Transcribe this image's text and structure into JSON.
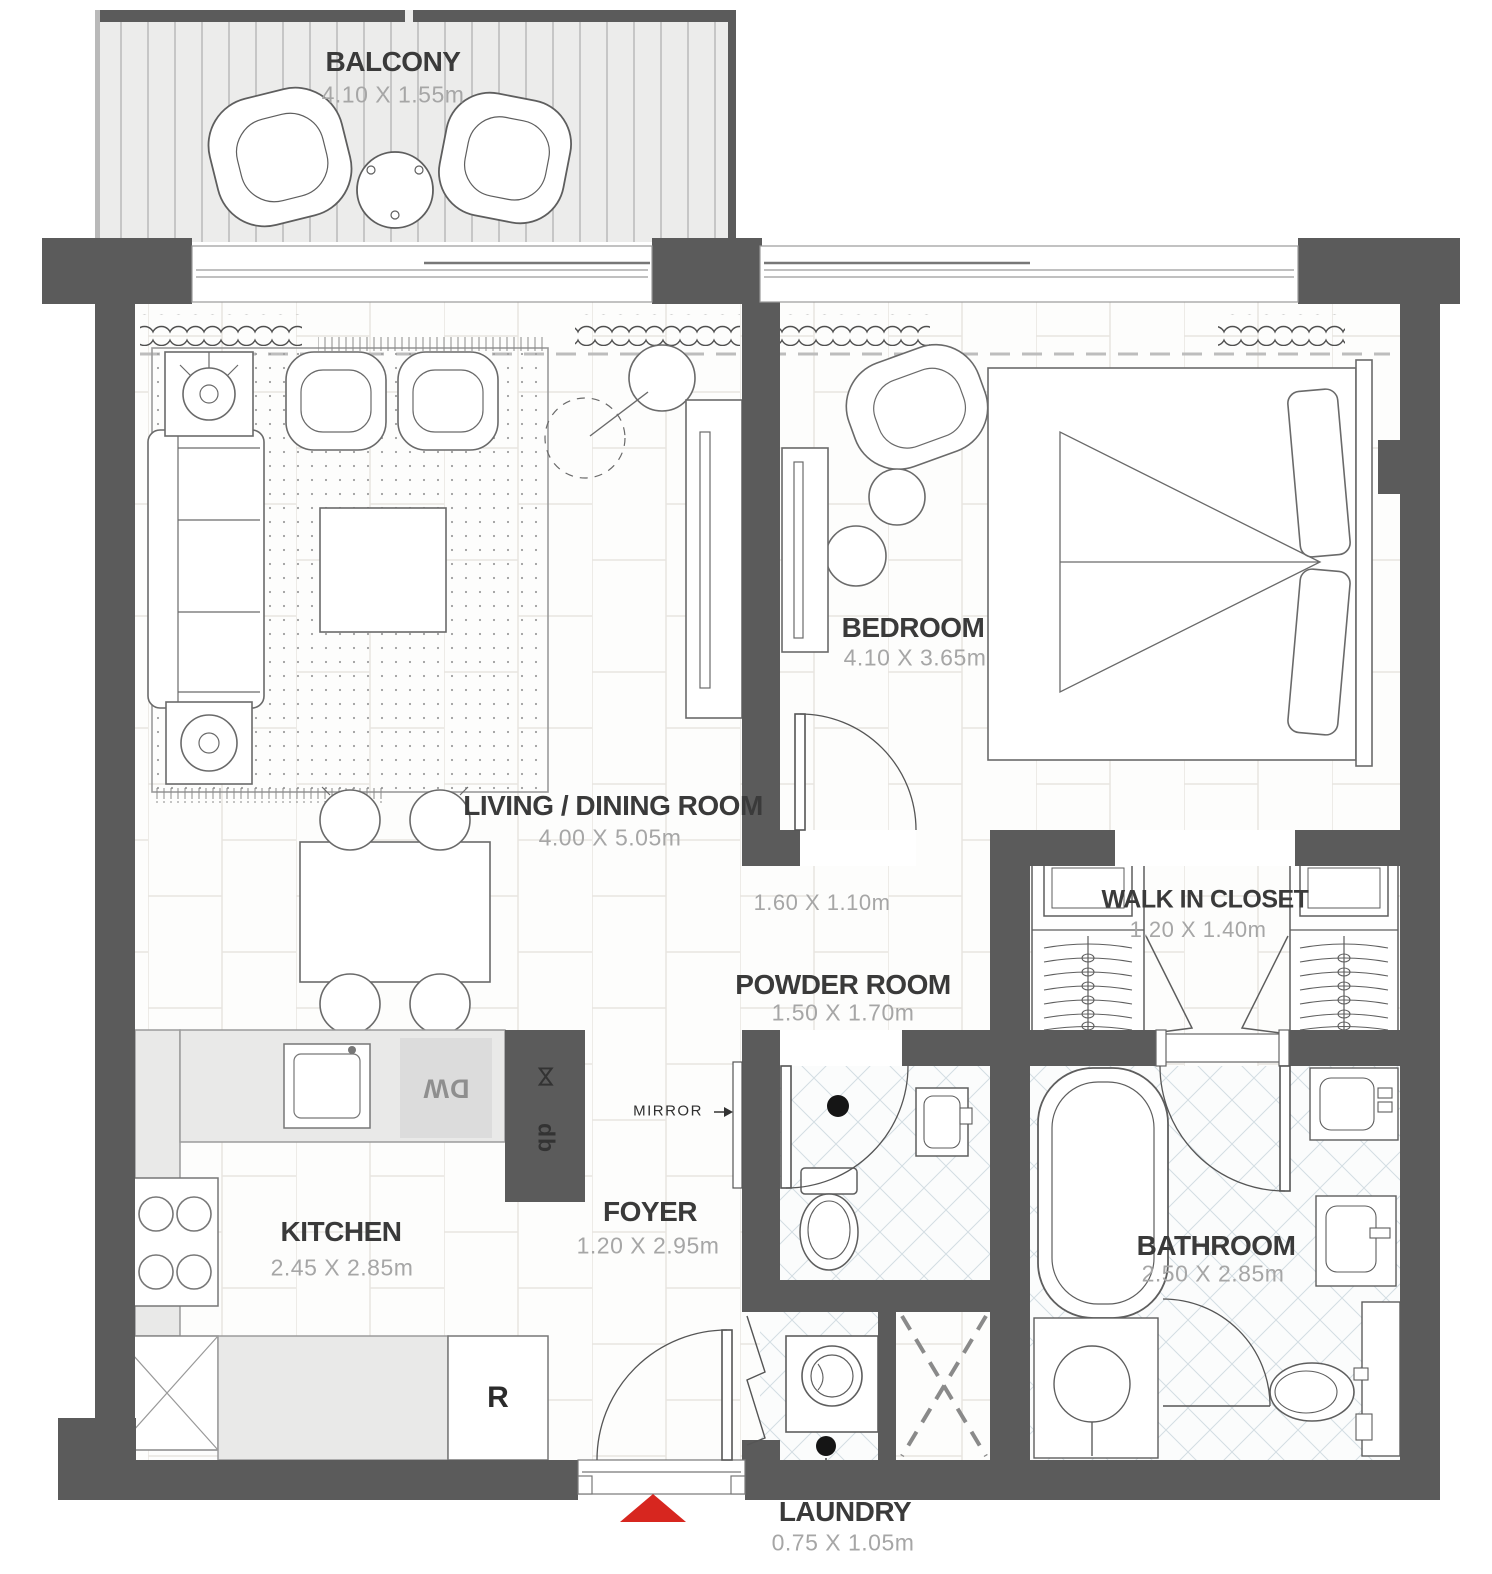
{
  "rooms": {
    "balcony": {
      "name": "BALCONY",
      "dims": "4.10 X 1.55m"
    },
    "living": {
      "name": "LIVING / DINING ROOM",
      "dims": "4.00 X 5.05m"
    },
    "bedroom": {
      "name": "BEDROOM",
      "dims": "4.10 X 3.65m"
    },
    "hall": {
      "dims": "1.60 X 1.10m"
    },
    "closet": {
      "name": "WALK IN CLOSET",
      "dims": "1.20 X 1.40m"
    },
    "powder": {
      "name": "POWDER ROOM",
      "dims": "1.50 X 1.70m"
    },
    "foyer": {
      "name": "FOYER",
      "dims": "1.20 X 2.95m"
    },
    "kitchen": {
      "name": "KITCHEN",
      "dims": "2.45 X 2.85m"
    },
    "bathroom": {
      "name": "BATHROOM",
      "dims": "2.50 X 2.85m"
    },
    "laundry": {
      "name": "LAUNDRY",
      "dims": "0.75 X 1.05m"
    }
  },
  "labels": {
    "mirror": "MIRROR",
    "dishwasher": "DW",
    "refrigerator": "R",
    "tall_unit_upper": "⋈",
    "tall_unit_lower": "db"
  },
  "colors": {
    "wall": "#5b5b5b",
    "entry_arrow": "#d7261f",
    "room_text": "#3a3a3a",
    "dim_text": "#a6a6a6",
    "appliance_text": "#8f8f8f"
  }
}
